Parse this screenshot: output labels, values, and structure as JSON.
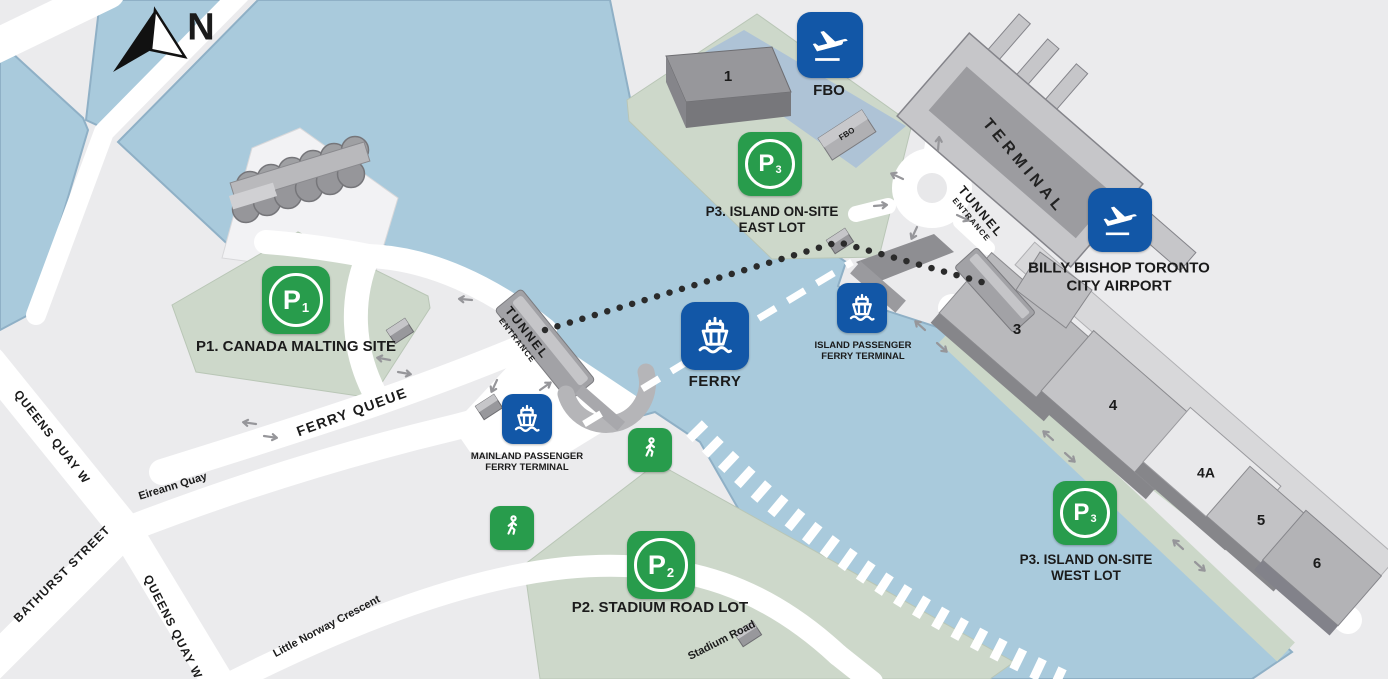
{
  "compass_n": "N",
  "fbo": {
    "icon_label": "FBO",
    "building_label": "FBO"
  },
  "airport": {
    "line1": "BILLY BISHOP TORONTO",
    "line2": "CITY AIRPORT"
  },
  "terminal_label": "TERMINAL",
  "tunnel_island": {
    "line1": "TUNNEL",
    "line2": "ENTRANCE"
  },
  "tunnel_mainland": {
    "line1": "TUNNEL",
    "line2": "ENTRANCE"
  },
  "ferry_label": "FERRY",
  "terminals": {
    "island": {
      "line1": "ISLAND PASSENGER",
      "line2": "FERRY TERMINAL"
    },
    "mainland": {
      "line1": "MAINLAND PASSENGER",
      "line2": "FERRY TERMINAL"
    }
  },
  "parking": {
    "p1": {
      "letter": "P",
      "sub": "1",
      "label": "P1. CANADA MALTING SITE"
    },
    "p2": {
      "letter": "P",
      "sub": "2",
      "label": "P2. STADIUM ROAD LOT"
    },
    "p3_east": {
      "letter": "P",
      "sub": "3",
      "line1": "P3. ISLAND ON-SITE",
      "line2": "EAST LOT"
    },
    "p3_west": {
      "letter": "P",
      "sub": "3",
      "line1": "P3. ISLAND ON-SITE",
      "line2": "WEST LOT"
    }
  },
  "streets": {
    "queens_quay_upper": "QUEENS QUAY W",
    "queens_quay_lower": "QUEENS QUAY W",
    "bathurst": "BATHURST STREET",
    "eireann": "Eireann Quay",
    "ferry_queue": "FERRY QUEUE",
    "little_norway": "Little Norway Crescent",
    "stadium": "Stadium Road"
  },
  "buildings": {
    "b1": "1",
    "b3": "3",
    "b4": "4",
    "b4a": "4A",
    "b5": "5",
    "b6": "6"
  },
  "colors": {
    "water": "#a9cadc",
    "land": "#ebebed",
    "road": "#ffffff",
    "lot_green": "#cdd8ca",
    "apron_blue": "#aec3d6",
    "icon_green": "#289c4c",
    "icon_blue": "#1257a7",
    "text": "#1b1b1b"
  }
}
